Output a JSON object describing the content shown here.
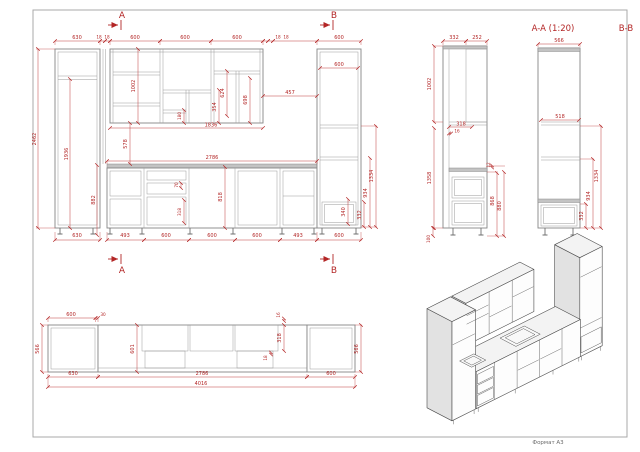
{
  "drawing": {
    "format_label": "Формат А3",
    "section_label_aa": "A-A (1:20)",
    "section_label_bb": "B-B",
    "markers": {
      "top_a": "A",
      "top_b": "B",
      "bottom_a": "A",
      "bottom_b": "B"
    },
    "front": {
      "top": [
        "630",
        "18",
        "18",
        "600",
        "600",
        "600",
        "18",
        "18",
        "600"
      ],
      "left": [
        "2462",
        "1936",
        "882"
      ],
      "wall": [
        "1002",
        "624",
        "698",
        "354",
        "180",
        "457",
        "1836",
        "578"
      ],
      "base": [
        "2786",
        "70",
        "318",
        "818",
        "340"
      ],
      "right": [
        "600",
        "1334",
        "934",
        "332"
      ],
      "bottom": [
        "630",
        "493",
        "600",
        "600",
        "600",
        "493",
        "600"
      ]
    },
    "section1": {
      "top": [
        "332",
        "252"
      ],
      "left": [
        "1002",
        "1358"
      ],
      "mid": [
        "318",
        "16"
      ],
      "right": [
        "12",
        "868",
        "880"
      ],
      "leg": "100"
    },
    "section2": {
      "top": "566",
      "mid": "518",
      "right": [
        "1334",
        "934",
        "332"
      ]
    },
    "plan": {
      "top": [
        "600",
        "30"
      ],
      "left": "566",
      "mid": "601",
      "small": [
        "16",
        "318",
        "18"
      ],
      "right": "566",
      "bottom": [
        "630",
        "2786",
        "600",
        "4016"
      ]
    }
  },
  "colors": {
    "dimension": "#b32626",
    "cabinet_line": "#878787",
    "iso_line": "#4a4a4a"
  }
}
